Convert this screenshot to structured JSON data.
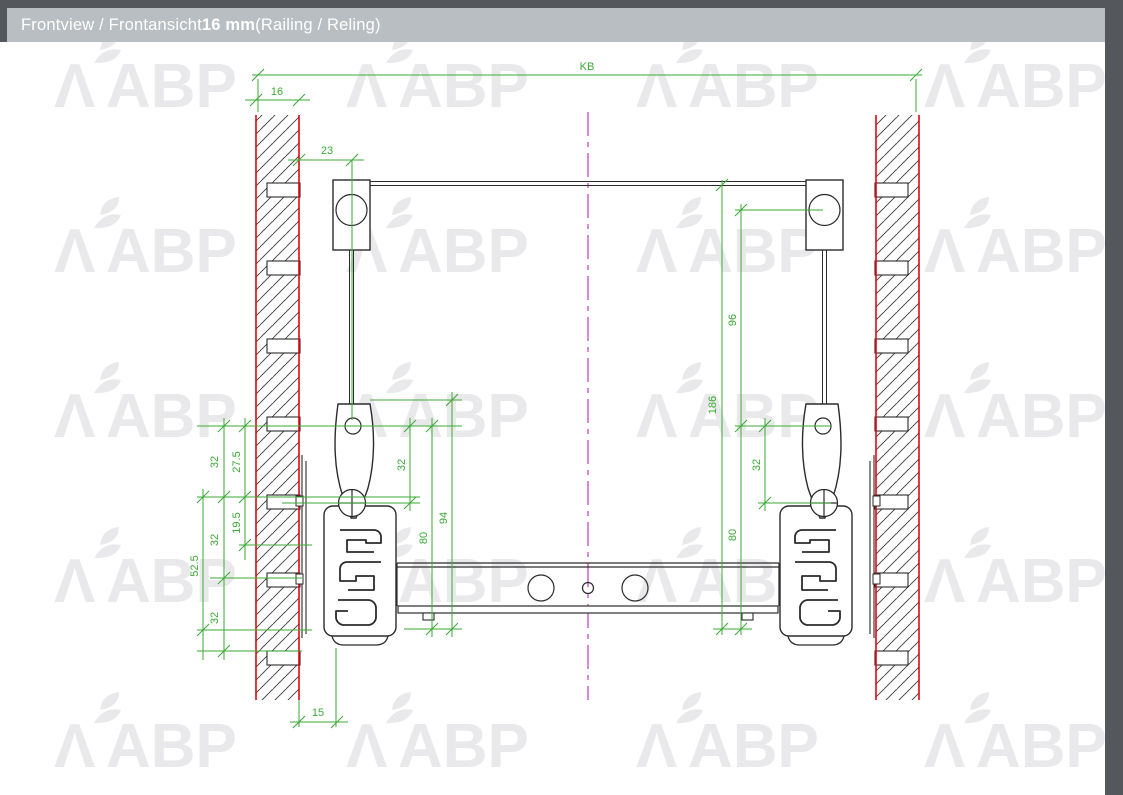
{
  "title": {
    "prefix": "Frontview / Frontansicht ",
    "bold": "16 mm",
    "suffix": " (Railing / Reling)"
  },
  "watermark": {
    "lambda": "Λ",
    "text": "ABP"
  },
  "colors": {
    "frame_dark": "#54585c",
    "titlebar_bg": "#b9bec2",
    "dimension_green": "#3aaa35",
    "wall_face_red": "#e30613",
    "centerline_magenta": "#c23ac2",
    "drawing_line": "#2b2b2b",
    "watermark_gray": "#e9e9ec"
  },
  "dims": {
    "kb": "KB",
    "wall_thickness": "16",
    "railing_offset": "23",
    "railing_to_hole": "96",
    "railing_height": "186",
    "left_hole_to_screw": "32",
    "left_80": "80",
    "left_94": "94",
    "right_hole_to_screw": "32",
    "right_80": "80",
    "sys32_top": "32",
    "sys32_mid": "32",
    "sys32_bot": "32",
    "d27_5": "27.5",
    "d19_5": "19.5",
    "d52_5": "52.5",
    "bottom_clearance": "15"
  }
}
